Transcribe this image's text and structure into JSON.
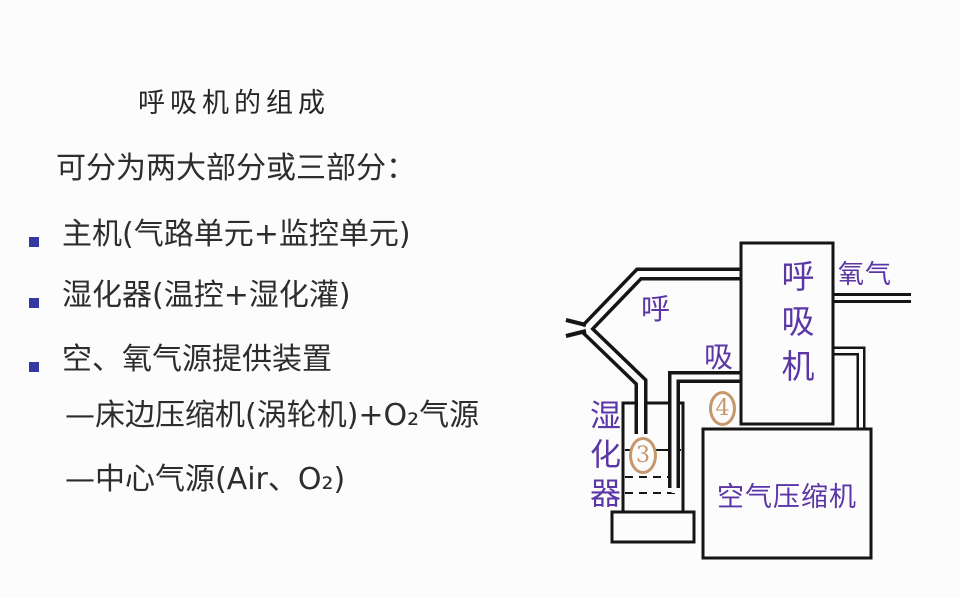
{
  "background": "#fcfcfc",
  "colors": {
    "text": "#2d2d2d",
    "bullet_square": "#3339a0",
    "diagram_label": "#5b36a6",
    "circle_number": "#c6976b",
    "line": "#151515"
  },
  "slide": {
    "title": "呼吸机的组成",
    "intro": "可分为两大部分或三部分：",
    "bullets": [
      {
        "label": "主机(气路单元+监控单元)"
      },
      {
        "label": "湿化器(温控+湿化灌)"
      },
      {
        "label": "空、氧气源提供装置"
      }
    ],
    "sub_items": [
      {
        "label": "—床边压缩机(涡轮机)+O₂气源"
      },
      {
        "label": "—中心气源(Air、O₂)"
      }
    ]
  },
  "diagram": {
    "ventilator_label": "呼吸机",
    "oxygen_label": "氧气",
    "exhale_label": "呼",
    "inhale_label": "吸",
    "humidifier_label": "湿化器",
    "compressor_label": "空气压缩机",
    "number_3": "3",
    "number_4": "4"
  }
}
